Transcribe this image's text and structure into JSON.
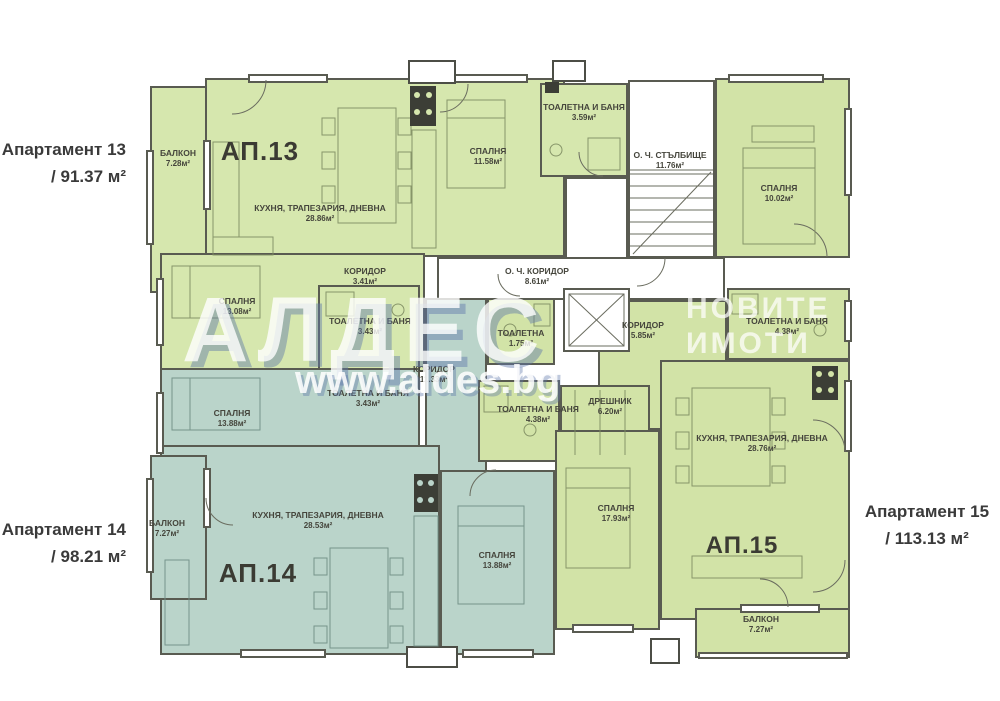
{
  "palette": {
    "ap13_fill": "#d6e7ae",
    "ap14_fill": "#bad4ca",
    "ap15_fill": "#d2e3a7",
    "wall": "#595b51",
    "label_text": "#45453c",
    "watermark_blue": "#6078aa"
  },
  "side_annotations": {
    "ap13": {
      "line1": "Апартамент 13",
      "line2": "/ 91.37 м²"
    },
    "ap14": {
      "line1": "Апартамент 14",
      "line2": "/ 98.21 м²"
    },
    "ap15": {
      "line1": "Апартамент 15",
      "line2": "/ 113.13 м²"
    }
  },
  "units": {
    "ap13": "АП.13",
    "ap14": "АП.14",
    "ap15": "АП.15"
  },
  "watermark": {
    "brand": "АЛДЕС",
    "tagline1": "НОВИТЕ",
    "tagline2": "ИМОТИ",
    "url": "www.aldes.bg"
  },
  "rooms": {
    "ap13_balcony": {
      "name": "БАЛКОН",
      "area": "7.28м²"
    },
    "ap13_living": {
      "name": "КУХНЯ, ТРАПЕЗАРИЯ, ДНЕВНА",
      "area": "28.86м²"
    },
    "ap13_bedroom1": {
      "name": "СПАЛНЯ",
      "area": "11.58м²"
    },
    "ap13_bath1": {
      "name": "ТОАЛЕТНА И БАНЯ",
      "area": "3.59м²"
    },
    "ap13_corridor": {
      "name": "КОРИДОР",
      "area": "3.41м²"
    },
    "ap13_bedroom2": {
      "name": "СПАЛНЯ",
      "area": "13.08м²"
    },
    "ap13_bath2": {
      "name": "ТОАЛЕТНА И БАНЯ",
      "area": "3.43м²"
    },
    "ap14_bedroom1": {
      "name": "СПАЛНЯ",
      "area": "13.88м²"
    },
    "ap14_bath1": {
      "name": "ТОАЛЕТНА И БАНЯ",
      "area": "3.43м²"
    },
    "ap14_corridor": {
      "name": "КОРИДОР",
      "area": "11.33м²"
    },
    "ap14_living": {
      "name": "КУХНЯ, ТРАПЕЗАРИЯ, ДНЕВНА",
      "area": "28.53м²"
    },
    "ap14_balcony": {
      "name": "БАЛКОН",
      "area": "7.27м²"
    },
    "ap14_bedroom2": {
      "name": "СПАЛНЯ",
      "area": "13.88м²"
    },
    "ap15_bedroom1": {
      "name": "СПАЛНЯ",
      "area": "10.02м²"
    },
    "ap15_bath1": {
      "name": "ТОАЛЕТНА И БАНЯ",
      "area": "4.38м²"
    },
    "ap15_corridor": {
      "name": "КОРИДОР",
      "area": "5.85м²"
    },
    "ap15_wc": {
      "name": "ТОАЛЕТНА",
      "area": "1.75м²"
    },
    "ap15_bath2": {
      "name": "ТОАЛЕТНА И БАНЯ",
      "area": "4.38м²"
    },
    "ap15_closet": {
      "name": "ДРЕШНИК",
      "area": "6.20м²"
    },
    "ap15_bedroom2": {
      "name": "СПАЛНЯ",
      "area": "17.93м²"
    },
    "ap15_living": {
      "name": "КУХНЯ, ТРАПЕЗАРИЯ, ДНЕВНА",
      "area": "28.76м²"
    },
    "ap15_balcony": {
      "name": "БАЛКОН",
      "area": "7.27м²"
    },
    "common_stairs": {
      "name": "О. Ч. СТЪЛБИЩЕ",
      "area": "11.76м²"
    },
    "common_corridor": {
      "name": "О. Ч. КОРИДОР",
      "area": "8.61м²"
    }
  }
}
